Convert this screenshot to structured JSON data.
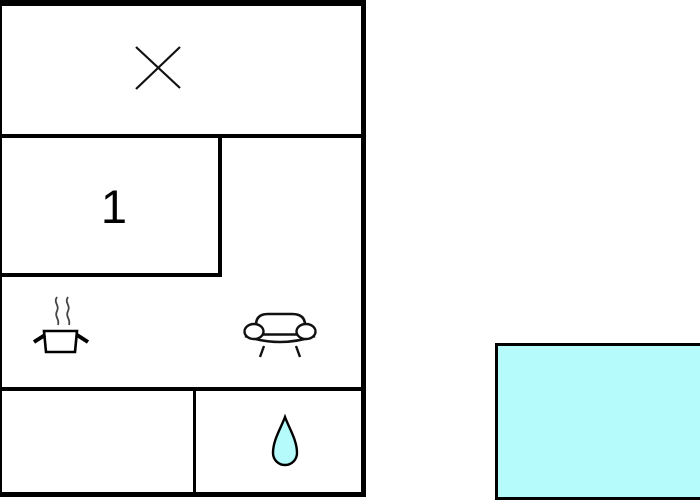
{
  "floor_plan": {
    "title": "holiday-home-floor-plan",
    "rooms": {
      "crossed_room": {
        "icon": "cross-icon",
        "label": ""
      },
      "bedroom": {
        "number": "1"
      },
      "kitchen_living": {
        "icons": [
          "cooking-pot-icon",
          "sofa-icon"
        ]
      },
      "utility_room": {
        "label": ""
      },
      "bathroom": {
        "icon": "water-drop-icon"
      }
    },
    "colors": {
      "wall": "#000000",
      "background": "#ffffff",
      "water": "#b6fbfb",
      "line": "#111111",
      "steam": "#444444"
    }
  },
  "pool": {
    "type": "swimming-pool",
    "color": "#b6fbfb"
  }
}
